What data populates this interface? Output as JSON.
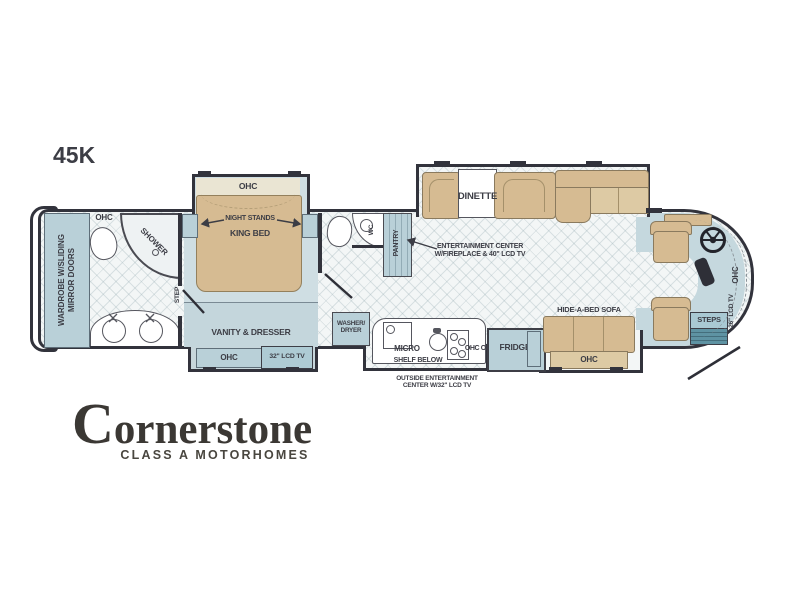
{
  "model": "45K",
  "common": {
    "ohc": "OHC"
  },
  "rear": {
    "wardrobe_line1": "WARDROBE W/SLIDING",
    "wardrobe_line2": "MIRROR DOORS"
  },
  "bath": {
    "shower": "SHOWER",
    "step": "STEP"
  },
  "bedroom": {
    "night_stands": "NIGHT STANDS",
    "king_bed": "KING BED",
    "vanity_dresser": "VANITY & DRESSER",
    "tv": "32\" LCD TV"
  },
  "midbath": {
    "wc": "WC",
    "pantry": "PANTRY"
  },
  "living": {
    "dinette": "DINETTE",
    "entertainment_line1": "ENTERTAINMENT CENTER",
    "entertainment_line2": "W/FIREPLACE & 40\" LCD TV",
    "hide_a_bed_sofa": "HIDE-A-BED SOFA"
  },
  "kitchen": {
    "washer_line1": "WASHER/",
    "washer_line2": "DRYER",
    "micro": "MICRO",
    "ohc_ohc": "OHC OHC",
    "fridge": "FRIDGE",
    "shelf_below": "SHELF BELOW",
    "outside_line1": "OUTSIDE ENTERTAINMENT",
    "outside_line2": "CENTER W/32\" LCD TV"
  },
  "front": {
    "steps": "STEPS",
    "tv": "26\" LCD TV"
  },
  "logo": {
    "brand": "Cornerstone",
    "tagline": "CLASS A MOTORHOMES"
  },
  "colors": {
    "wall": "#32333c",
    "blue": "#b9d0d8",
    "blue-lt": "#c4d6dc",
    "tan": "#d6bb92",
    "tan-lt": "#ddcaa4",
    "cream": "#eae5d3",
    "floor": "#f3f6f6",
    "bedfloor": "#cfdee3",
    "cabfloor": "#c5d8de",
    "teal": "#5e93a3",
    "ink": "#3c3d45",
    "logo": "#3b3834"
  }
}
